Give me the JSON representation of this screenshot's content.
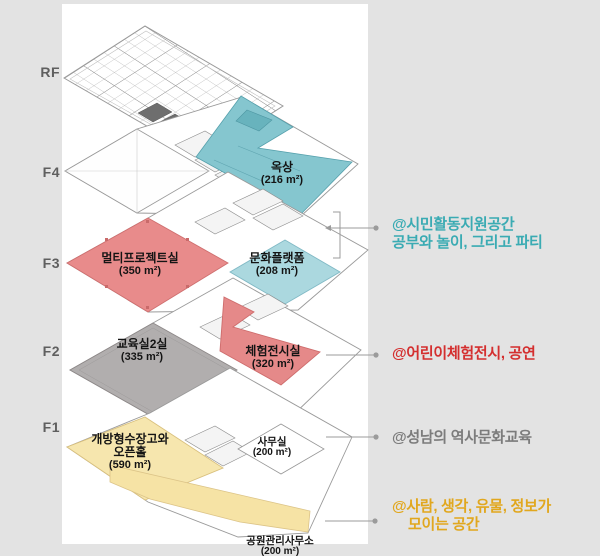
{
  "colors": {
    "background": "#e3e3e3",
    "panel": "#ffffff",
    "rooftop": "#85c6cf",
    "culture_platform": "#abd8df",
    "multiproject": "#e88b8b",
    "experience_hall": "#e58989",
    "classrooms": "#b1aeae",
    "open_storage": "#f6e6ae",
    "park_band": "#f6e3a5",
    "connector": "#9b9b9b",
    "floor_label": "#5f5f5f",
    "annotation_citizen": "#3aabb3",
    "annotation_children": "#d42f2f",
    "annotation_history": "#7c7c7c",
    "annotation_gathering": "#e1a71e"
  },
  "floors": {
    "rf": "RF",
    "f4": "F4",
    "f3": "F3",
    "f2": "F2",
    "f1": "F1"
  },
  "rooms": {
    "rooftop": {
      "floor": "F4",
      "name": "옥상",
      "area": "(216 m²)"
    },
    "multiproject": {
      "floor": "F3",
      "name": "멀티프로젝트실",
      "area": "(350 m²)"
    },
    "culture_platform": {
      "floor": "F3",
      "name": "문화플랫폼",
      "area": "(208 m²)"
    },
    "classrooms": {
      "floor": "F2",
      "name": "교육실2실",
      "area": "(335 m²)"
    },
    "experience_hall": {
      "floor": "F2",
      "name": "체험전시실",
      "area": "(320 m²)"
    },
    "open_storage": {
      "floor": "F1",
      "name_line1": "개방형수장고와",
      "name_line2": "오픈홀",
      "area": "(590 m²)"
    },
    "office": {
      "floor": "F1",
      "name": "사무실",
      "area": "(200 m²)"
    },
    "park_office": {
      "floor": "F1",
      "name": "공원관리사무소",
      "area": "(200 m²)"
    }
  },
  "annotations": {
    "citizen": {
      "line1": "@시민활동지원공간",
      "line2": "공부와 놀이, 그리고 파티"
    },
    "children": {
      "line1": "@어린이체험전시, 공연"
    },
    "history": {
      "line1": "@성남의 역사문화교육"
    },
    "gathering": {
      "line1": "@사람, 생각, 유물, 정보가",
      "line2": "모이는 공간"
    }
  }
}
